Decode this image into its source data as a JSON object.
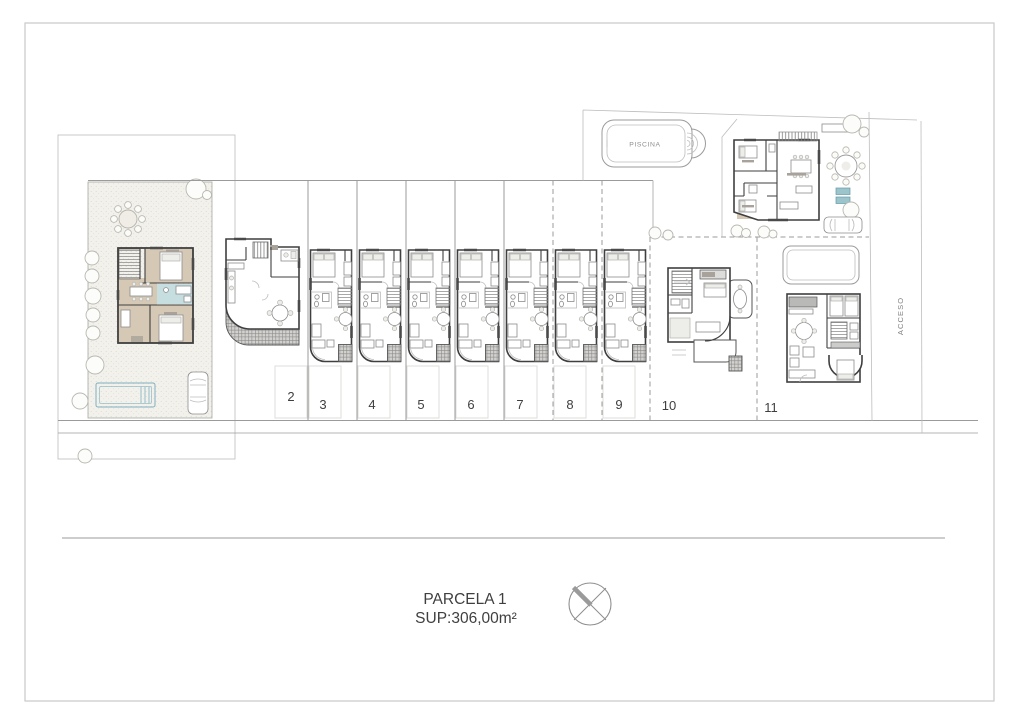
{
  "drawing": {
    "pool_label": "PISCINA",
    "access_label": "ACCESO",
    "parcel_title": "PARCELA 1",
    "parcel_area": "SUP:306,00m²",
    "plot_numbers": [
      "2",
      "3",
      "4",
      "5",
      "6",
      "7",
      "8",
      "9",
      "10",
      "11"
    ]
  },
  "colors": {
    "paper": "#ffffff",
    "border": "#c9c9c9",
    "line": "#9b9b9b",
    "wall": "#3f3f3f",
    "room_beige": "#d5c8b5",
    "bath_teal": "#c6dee0",
    "text": "#3f3f3f"
  }
}
